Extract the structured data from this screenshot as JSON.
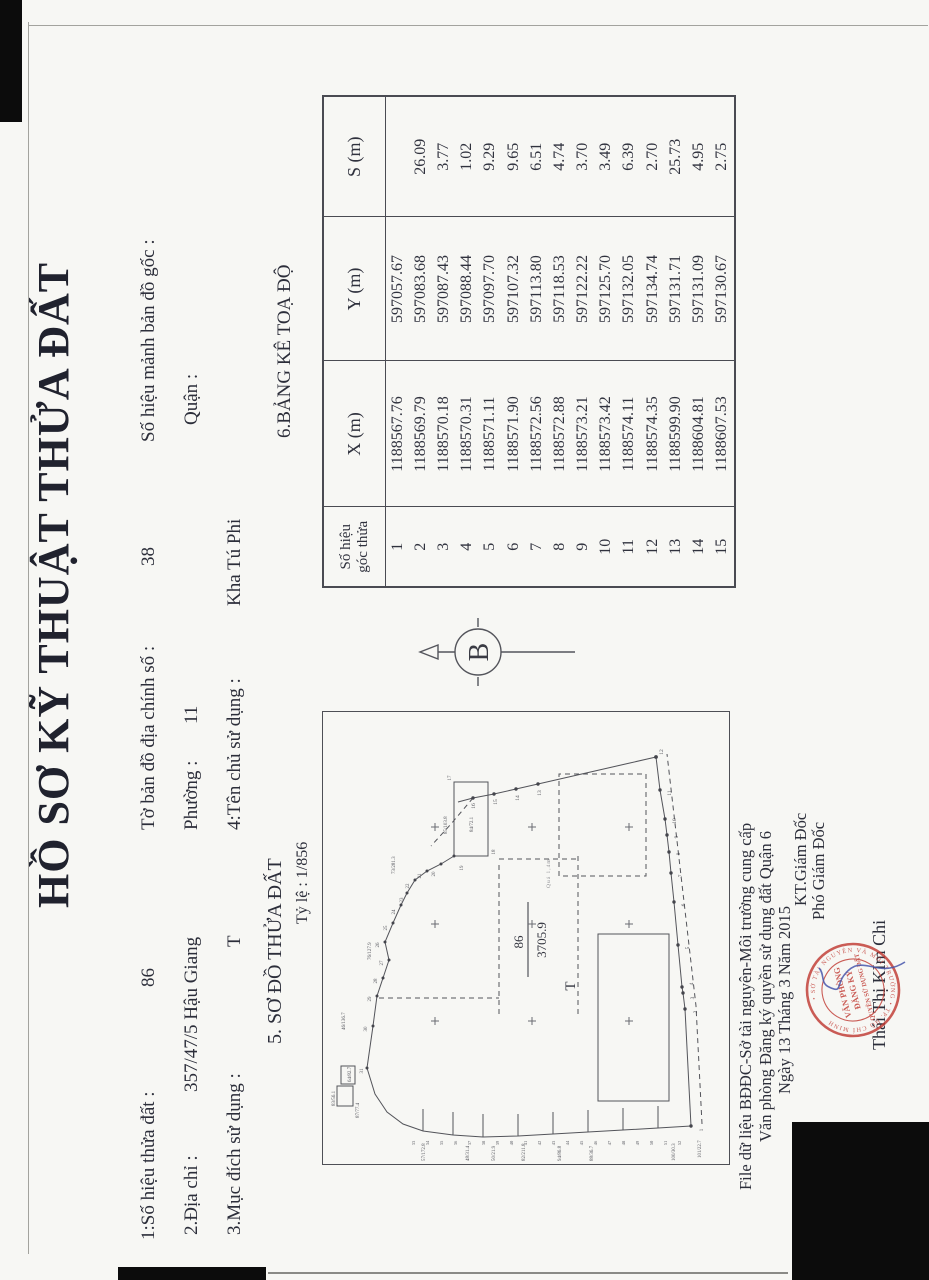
{
  "title": "HỒ SƠ KỸ THUẬT THỬA ĐẤT",
  "fields": {
    "parcel_label": "1:Số hiệu thửa đất :",
    "parcel_value": "86",
    "map_sheet_label": "Tờ bản đồ địa chính số :",
    "map_sheet_value": "38",
    "orig_sheet_label": "Số hiệu mảnh bản đồ gốc :",
    "address_label": "2.Địa chỉ :",
    "address_value": "357/47/5 Hậu Giang",
    "ward_label": "Phường :",
    "ward_value": "11",
    "district_label": "Quận :",
    "purpose_label": "3.Mục đích sử dụng :",
    "purpose_value": "T",
    "owner_label": "4:Tên chủ sử dụng :",
    "owner_value": "Kha Tú Phi"
  },
  "diagram": {
    "section_label": "5. SƠ ĐỒ THỬA ĐẤT",
    "scale_label": "Tỷ lệ : 1/856",
    "north_label": "B",
    "parcel_number": "86",
    "parcel_area": "3705.9",
    "parcel_use": "T",
    "alley_label": "Quá 1,4m",
    "vmain": [
      "1",
      "2",
      "3",
      "4",
      "5",
      "6",
      "7",
      "8",
      "9",
      "10",
      "11",
      "12",
      "13",
      "14",
      "15",
      "16"
    ],
    "vouter": [
      "17",
      "18",
      "19",
      "20",
      "21",
      "22",
      "23",
      "24",
      "25",
      "26",
      "27",
      "28",
      "29",
      "30",
      "31"
    ],
    "vstrip": [
      "33",
      "34",
      "35",
      "36",
      "37",
      "38",
      "39",
      "40",
      "41",
      "42",
      "43",
      "44",
      "45",
      "46",
      "47",
      "48",
      "49",
      "50",
      "51",
      "52"
    ],
    "neighbors": [
      "83/56.1",
      "87/77.4",
      "64/82.7",
      "46/136.7",
      "76/127.9",
      "73/281.3",
      "85/103.8",
      "84/72.1",
      "57/172.8",
      "48/31.4",
      "50/21.9",
      "82/211.8",
      "94/86.8",
      "88/36.7",
      "100/30.3",
      "101/22.7"
    ]
  },
  "table": {
    "section_label": "6.BẢNG KÊ TOẠ ĐỘ",
    "headers": {
      "id1": "Số hiệu",
      "id2": "góc thửa",
      "x": "X (m)",
      "y": "Y (m)",
      "s": "S (m)"
    },
    "rows": [
      {
        "n": "1",
        "x": "1188567.76",
        "y": "597057.67",
        "s": ""
      },
      {
        "n": "2",
        "x": "1188569.79",
        "y": "597083.68",
        "s": "26.09"
      },
      {
        "n": "3",
        "x": "1188570.18",
        "y": "597087.43",
        "s": "3.77"
      },
      {
        "n": "4",
        "x": "1188570.31",
        "y": "597088.44",
        "s": "1.02"
      },
      {
        "n": "5",
        "x": "1188571.11",
        "y": "597097.70",
        "s": "9.29"
      },
      {
        "n": "6",
        "x": "1188571.90",
        "y": "597107.32",
        "s": "9.65"
      },
      {
        "n": "7",
        "x": "1188572.56",
        "y": "597113.80",
        "s": "6.51"
      },
      {
        "n": "8",
        "x": "1188572.88",
        "y": "597118.53",
        "s": "4.74"
      },
      {
        "n": "9",
        "x": "1188573.21",
        "y": "597122.22",
        "s": "3.70"
      },
      {
        "n": "10",
        "x": "1188573.42",
        "y": "597125.70",
        "s": "3.49"
      },
      {
        "n": "11",
        "x": "1188574.11",
        "y": "597132.05",
        "s": "6.39"
      },
      {
        "n": "12",
        "x": "1188574.35",
        "y": "597134.74",
        "s": "2.70"
      },
      {
        "n": "13",
        "x": "1188599.90",
        "y": "597131.71",
        "s": "25.73"
      },
      {
        "n": "14",
        "x": "1188604.81",
        "y": "597131.09",
        "s": "4.95"
      },
      {
        "n": "15",
        "x": "1188607.53",
        "y": "597130.67",
        "s": "2.75"
      }
    ]
  },
  "footer": {
    "line1": "File dữ liệu BĐĐC-Sở tài nguyên-Môi trường cung cấp",
    "line2": "Văn phòng Đăng ký quyền sử dụng đất Quận 6",
    "line3": "Ngày 13 Tháng 3 Năm 2015",
    "kt": "KT.Giám Đốc",
    "deputy": "Phó Giám Đốc",
    "signer": "Thái Thị KIm Chi",
    "stamp": {
      "center1": "VĂN PHÒNG",
      "center2": "ĐĂNG KÝ",
      "center3": "QUYỀN SỬ DỤNG ĐẤT",
      "ring": "• SỞ TÀI NGUYÊN VÀ MÔI TRƯỜNG • TP. HỒ CHÍ MINH"
    }
  },
  "colors": {
    "ink": "#2c2e3a",
    "line": "#4e4f55",
    "stamp_red": "#c03a33",
    "signature_blue": "#4656ac",
    "paper": "#f7f7f4"
  }
}
